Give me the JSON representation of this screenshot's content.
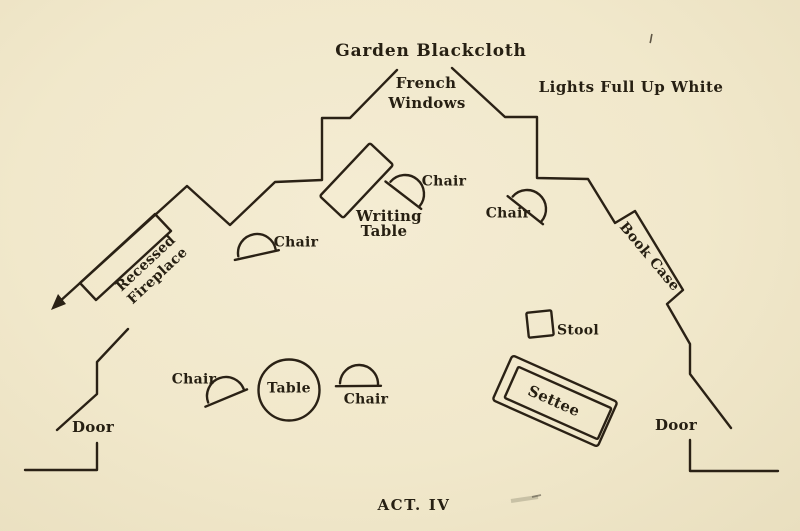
{
  "colors": {
    "paper": "#f1e8cb",
    "ink": "#2a2115"
  },
  "backdrop": {
    "label": "Garden Blackcloth"
  },
  "french_windows": {
    "line1": "French",
    "line2": "Windows"
  },
  "lighting": {
    "note": "Lights Full Up White"
  },
  "act_caption": "ACT. IV",
  "furniture": {
    "fireplace": {
      "line1": "Recessed",
      "line2": "Fireplace"
    },
    "writing_table": {
      "line1": "Writing",
      "line2": "Table"
    },
    "book_case": "Book Case",
    "round_table": "Table",
    "stool": "Stool",
    "settee": "Settee",
    "chairs": {
      "by_fireplace": "Chair",
      "at_writing_table": "Chair",
      "stage_left_of_windows": "Chair",
      "down_left": "Chair",
      "down_center": "Chair"
    },
    "doors": {
      "left": "Door",
      "right": "Door"
    }
  }
}
